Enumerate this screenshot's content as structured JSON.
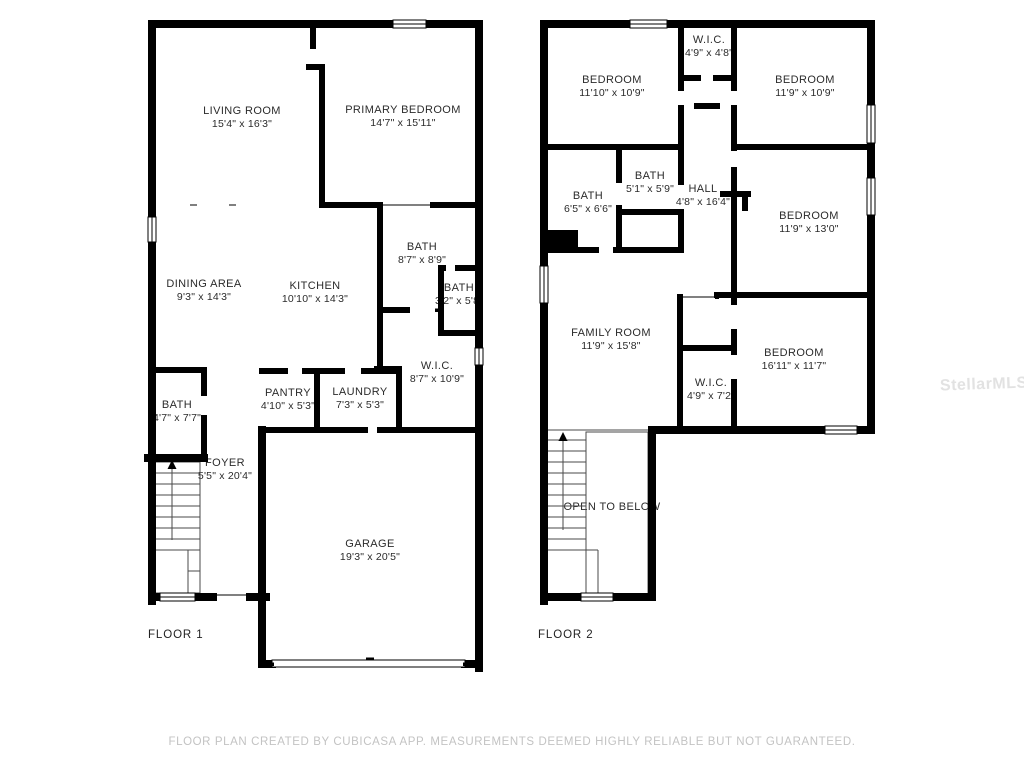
{
  "colors": {
    "wall": "#000000",
    "room_text": "#2b2b2b",
    "footer_text": "#c3c3c3",
    "watermark_text": "#e2e2e2",
    "background": "#ffffff"
  },
  "floors": [
    {
      "label": "FLOOR 1",
      "rooms": [
        {
          "name": "LIVING ROOM",
          "dims": "15'4\" x 16'3\""
        },
        {
          "name": "PRIMARY BEDROOM",
          "dims": "14'7\" x 15'11\""
        },
        {
          "name": "BATH",
          "dims": "8'7\" x 8'9\""
        },
        {
          "name": "BATH",
          "dims": "3'2\" x 5'8\""
        },
        {
          "name": "DINING AREA",
          "dims": "9'3\" x 14'3\""
        },
        {
          "name": "KITCHEN",
          "dims": "10'10\" x 14'3\""
        },
        {
          "name": "W.I.C.",
          "dims": "8'7\" x 10'9\""
        },
        {
          "name": "PANTRY",
          "dims": "4'10\" x 5'3\""
        },
        {
          "name": "LAUNDRY",
          "dims": "7'3\" x 5'3\""
        },
        {
          "name": "BATH",
          "dims": "4'7\" x 7'7\""
        },
        {
          "name": "FOYER",
          "dims": "5'5\" x 20'4\""
        },
        {
          "name": "GARAGE",
          "dims": "19'3\" x 20'5\""
        }
      ]
    },
    {
      "label": "FLOOR 2",
      "rooms": [
        {
          "name": "W.I.C.",
          "dims": "4'9\" x 4'8\""
        },
        {
          "name": "BEDROOM",
          "dims": "11'10\" x 10'9\""
        },
        {
          "name": "BEDROOM",
          "dims": "11'9\" x 10'9\""
        },
        {
          "name": "BATH",
          "dims": "5'1\" x 5'9\""
        },
        {
          "name": "BATH",
          "dims": "6'5\" x 6'6\""
        },
        {
          "name": "HALL",
          "dims": "4'8\" x 16'4\""
        },
        {
          "name": "BEDROOM",
          "dims": "11'9\" x 13'0\""
        },
        {
          "name": "FAMILY ROOM",
          "dims": "11'9\" x 15'8\""
        },
        {
          "name": "BEDROOM",
          "dims": "16'11\" x 11'7\""
        },
        {
          "name": "W.I.C.",
          "dims": "4'9\" x 7'2\""
        },
        {
          "name": "OPEN TO BELOW",
          "dims": ""
        }
      ]
    }
  ],
  "footer": "FLOOR PLAN CREATED BY CUBICASA APP. MEASUREMENTS DEEMED HIGHLY RELIABLE BUT NOT GUARANTEED.",
  "watermark": "StellarMLS"
}
